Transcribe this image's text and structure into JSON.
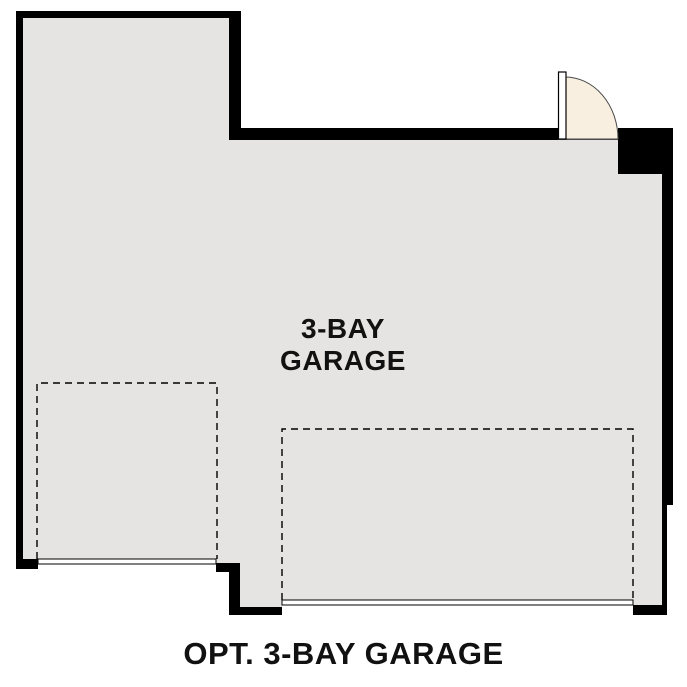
{
  "room": {
    "label_line1": "3-BAY",
    "label_line2": "GARAGE"
  },
  "caption": "OPT. 3-BAY GARAGE",
  "colors": {
    "wall": "#000000",
    "floor": "#e5e4e2",
    "door-fill": "#f8efe1",
    "door-stroke": "#4a4a4a",
    "line": "#000000",
    "text": "#111111",
    "background": "#ffffff"
  }
}
